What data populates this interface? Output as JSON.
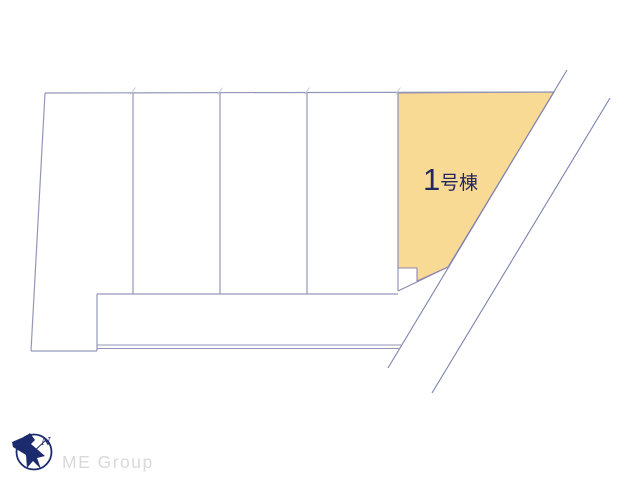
{
  "plan": {
    "building_label": {
      "number": "1",
      "suffix": "号棟"
    },
    "colors": {
      "lot_fill": "#F8DA95",
      "lot_stroke": "#8F87AF",
      "boundary_line": "#9396B7",
      "road_line": "#7E83AF",
      "tick": "#C8CADC",
      "label_text": "#23265F"
    }
  },
  "logo": {
    "company": "ME Group",
    "compass_letter": "N",
    "mark_color": "#1C2B6E",
    "text_color": "#D9D9D9"
  }
}
